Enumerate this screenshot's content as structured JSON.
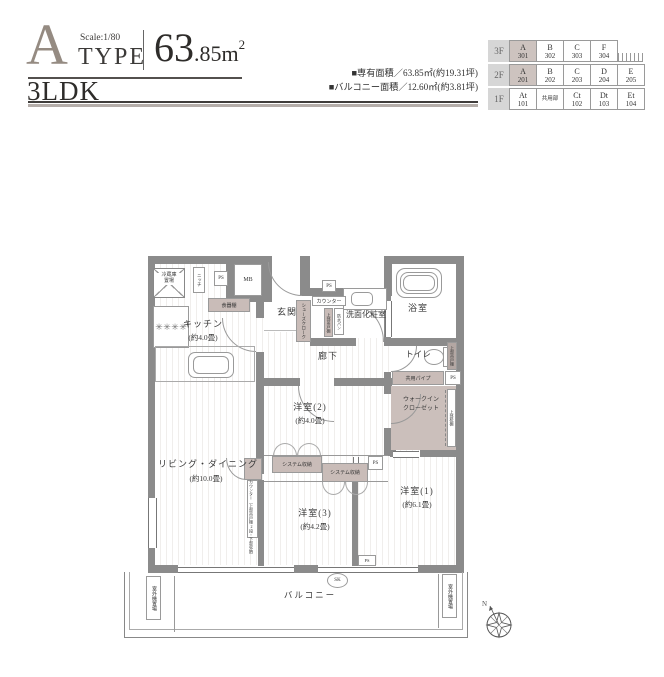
{
  "header": {
    "letter": "A",
    "scale": "Scale:1/80",
    "type_word": "TYPE",
    "area_int": "63",
    "area_dec": ".85m",
    "area_sup": "2",
    "layout": "3LDK",
    "spec1": "■専有面積／63.85㎡(約19.31坪)",
    "spec2": "■バルコニー面積／12.60㎡(約3.81坪)"
  },
  "floor_table": {
    "rows": [
      {
        "floor": "3F",
        "cells": [
          {
            "n": "A",
            "r": "301",
            "hl": true
          },
          {
            "n": "B",
            "r": "302"
          },
          {
            "n": "C",
            "r": "303"
          },
          {
            "n": "F",
            "r": "304"
          }
        ]
      },
      {
        "floor": "2F",
        "cells": [
          {
            "n": "A",
            "r": "201",
            "hl": true
          },
          {
            "n": "B",
            "r": "202"
          },
          {
            "n": "C",
            "r": "203"
          },
          {
            "n": "D",
            "r": "204"
          },
          {
            "n": "E",
            "r": "205"
          }
        ]
      },
      {
        "floor": "1F",
        "cells": [
          {
            "n": "At",
            "r": "101"
          },
          {
            "n": "共用部",
            "r": ""
          },
          {
            "n": "Ct",
            "r": "102"
          },
          {
            "n": "Dt",
            "r": "103"
          },
          {
            "n": "Et",
            "r": "104"
          }
        ]
      }
    ]
  },
  "plan": {
    "kitchen": {
      "name": "キッチン",
      "size": "(約4.0畳)"
    },
    "living": {
      "name": "リビング・ダイニング",
      "size": "(約10.0畳)"
    },
    "bedroom1": {
      "name": "洋室(1)",
      "size": "(約6.1畳)"
    },
    "bedroom2": {
      "name": "洋室(2)",
      "size": "(約4.0畳)"
    },
    "bedroom3": {
      "name": "洋室(3)",
      "size": "(約4.2畳)"
    },
    "genkan": "玄関",
    "hallway": "廊下",
    "washroom": "洗面化粧室",
    "bathroom": "浴室",
    "toilet": "トイレ",
    "wic1": "ウォークイン",
    "wic2": "クローゼット",
    "balcony": "バルコニー",
    "fridge1": "冷蔵庫",
    "fridge2": "置場",
    "niche": "ニッチ",
    "cupboard": "食器棚",
    "shoes_closet": "シューズクローク",
    "counter": "カウンター",
    "waterproof_pan": "防水パン",
    "upper_cabinet": "上部吊戸棚",
    "upper_shelf": "上部枕棚",
    "pipe": "共用パイプ",
    "system_storage": "システム収納",
    "counter_living": "カウンター（上部吊戸棚2段・下部収納）",
    "outdoor_unit": "室外機置場",
    "mb": "MB",
    "ps": "PS",
    "sk": "SK",
    "compass_n": "N"
  },
  "icons": {
    "burner": "✳"
  },
  "colors": {
    "wall": "#8b8b8b",
    "storage_shade": "#c9bcb8",
    "table_highlight": "#cdc3bf",
    "accent_letter": "#958b82"
  }
}
